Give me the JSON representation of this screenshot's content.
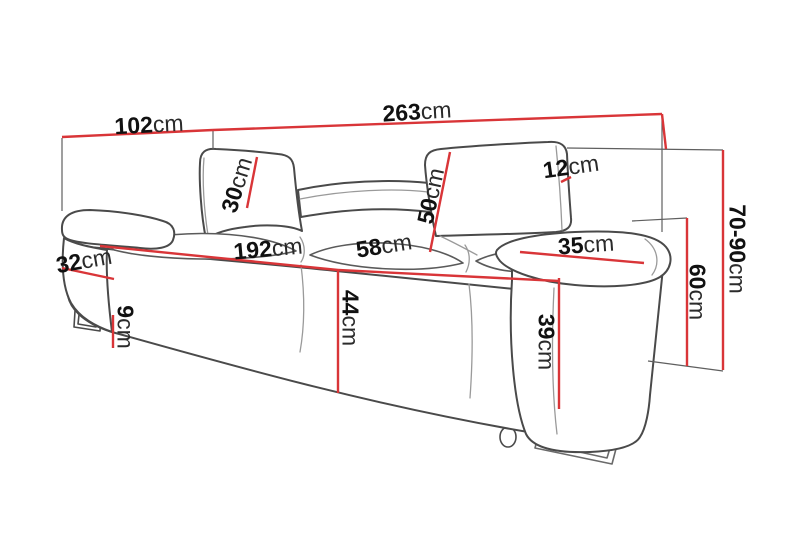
{
  "diagram": {
    "type": "furniture-dimension-diagram",
    "subject": "three-seat sofa with adjustable headrests",
    "unit": "cm",
    "colors": {
      "dimension_line": "#d93538",
      "outline": "#4a4a4a",
      "background": "#ffffff"
    },
    "dimensions": [
      {
        "id": "depth-overall",
        "value": "102",
        "unit": "cm"
      },
      {
        "id": "width-overall",
        "value": "263",
        "unit": "cm"
      },
      {
        "id": "headrest-thickness",
        "value": "12",
        "unit": "cm"
      },
      {
        "id": "headrest-height",
        "value": "30",
        "unit": "cm"
      },
      {
        "id": "backrest-height",
        "value": "50",
        "unit": "cm"
      },
      {
        "id": "seat-width",
        "value": "192",
        "unit": "cm"
      },
      {
        "id": "seat-depth",
        "value": "58",
        "unit": "cm"
      },
      {
        "id": "armrest-top-width",
        "value": "35",
        "unit": "cm"
      },
      {
        "id": "armrest-side-width",
        "value": "32",
        "unit": "cm"
      },
      {
        "id": "seat-height",
        "value": "44",
        "unit": "cm"
      },
      {
        "id": "leg-height",
        "value": "9",
        "unit": "cm"
      },
      {
        "id": "armrest-front-height",
        "value": "39",
        "unit": "cm"
      },
      {
        "id": "armrest-height",
        "value": "60",
        "unit": "cm"
      },
      {
        "id": "total-height-adjustable",
        "value": "70-90",
        "unit": "cm"
      }
    ]
  }
}
